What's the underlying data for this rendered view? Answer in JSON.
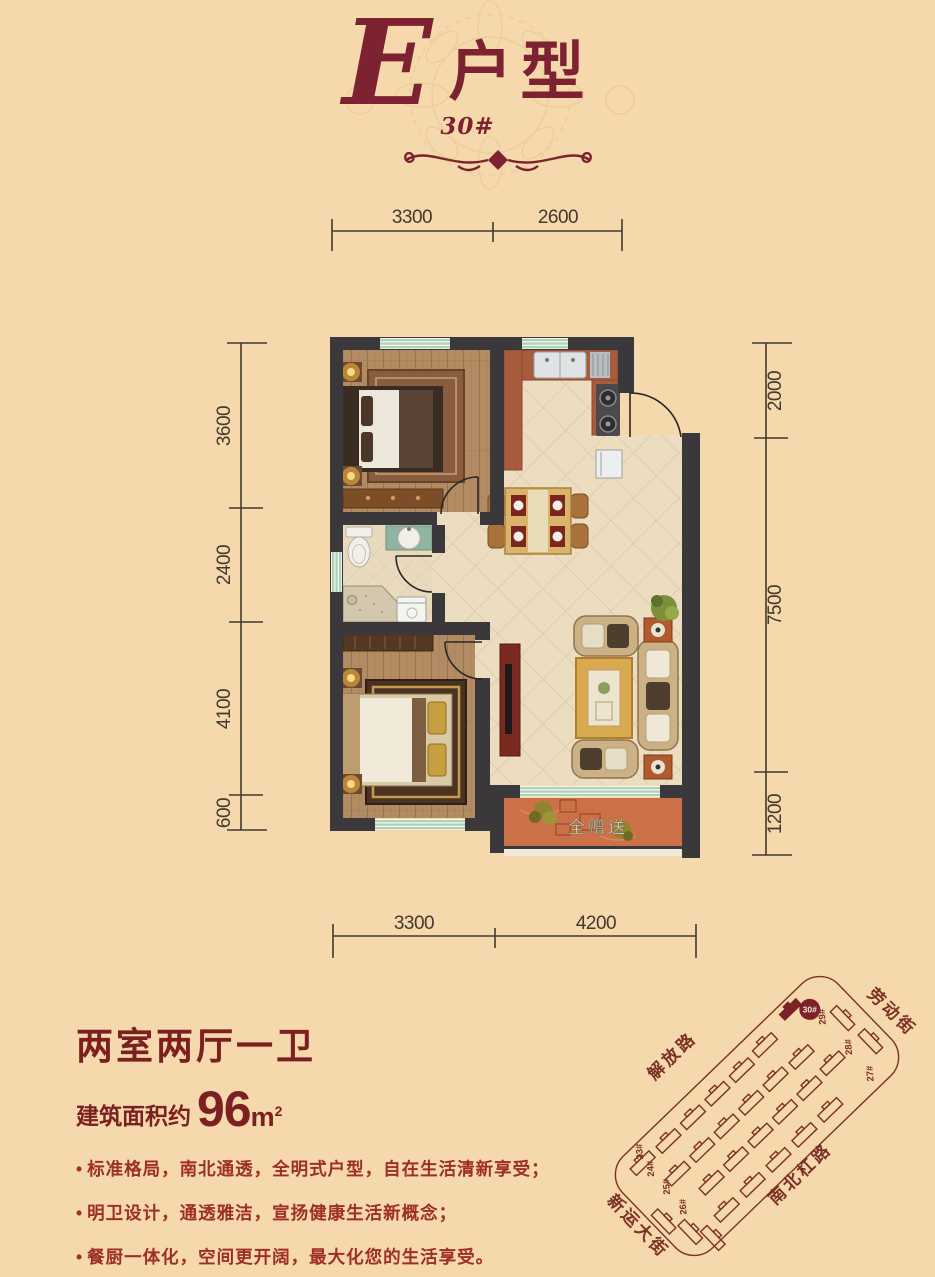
{
  "title": {
    "letter": "E",
    "type_label": "户型",
    "building_no": "30#"
  },
  "dimensions": {
    "top": [
      "3300",
      "2600"
    ],
    "bottom": [
      "3300",
      "4200"
    ],
    "left": [
      "3600",
      "2400",
      "4100",
      "600"
    ],
    "right": [
      "2000",
      "7500",
      "1200"
    ]
  },
  "floorplan": {
    "balcony_label": "全赠送"
  },
  "info": {
    "layout": "两室两厅一卫",
    "area_prefix": "建筑面积约",
    "area_value": "96",
    "area_unit": "m",
    "area_sup": "2",
    "features": [
      "标准格局，南北通透，全明式户型，自在生活清新享受；",
      "明卫设计，通透雅洁，宣扬健康生活新概念；",
      "餐厨一体化，空间更开阔，最大化您的生活享受。"
    ]
  },
  "sitemap": {
    "roads": [
      "劳动街",
      "解放路",
      "南北杠路",
      "新运大街"
    ],
    "buildings": [
      "30#",
      "29#",
      "28#",
      "27#",
      "23#",
      "24#",
      "25#",
      "26#"
    ],
    "highlighted": "30#"
  },
  "colors": {
    "background": "#f5d8ab",
    "title_red": "#7d2230",
    "wall_dark": "#3a383a",
    "window_green": "#a9d3b8",
    "map_maroon": "#7c3126",
    "balcony_terracotta": "#cc7047",
    "counter_brown": "#a85c3e"
  }
}
